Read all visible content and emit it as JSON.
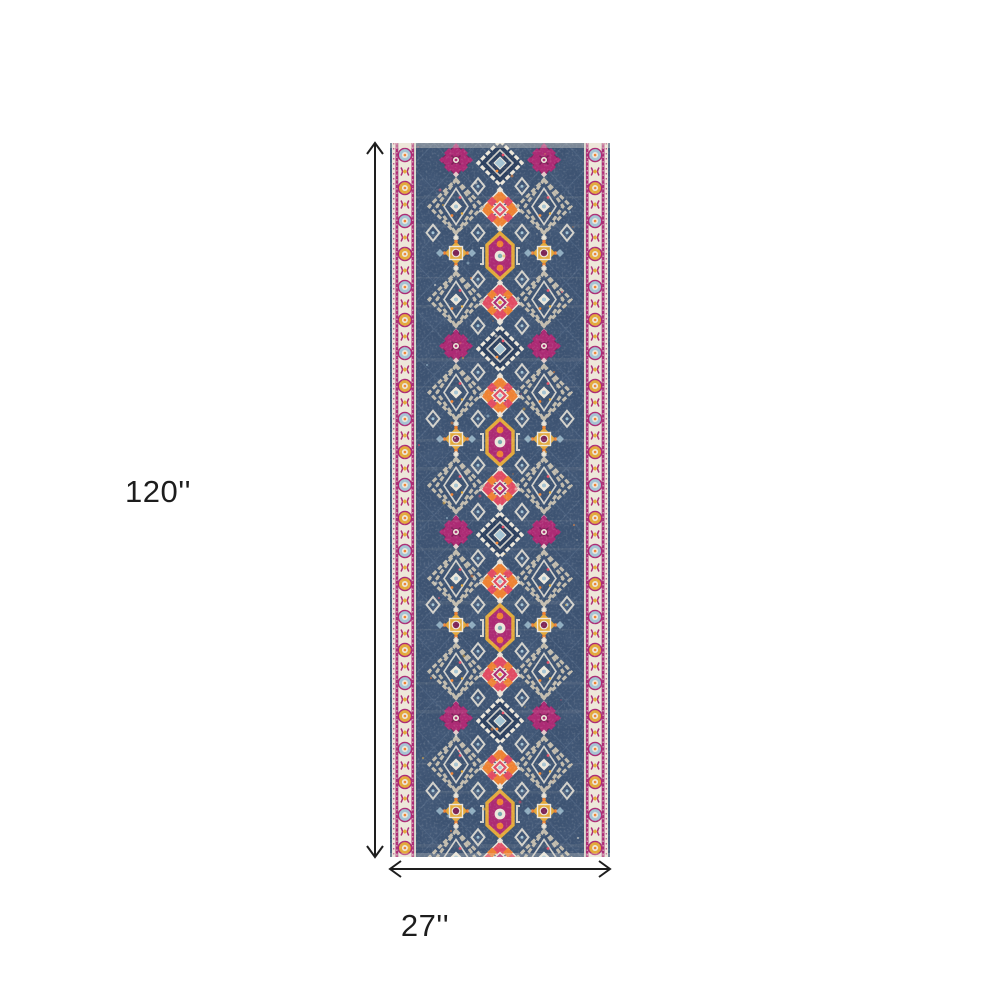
{
  "page": {
    "background": "#ffffff"
  },
  "diagram": {
    "type": "product-dimension-diagram",
    "length": {
      "label": "120''"
    },
    "width": {
      "label": "27''"
    },
    "arrow_color": "#1e1e1e",
    "text_color": "#1d1d1d"
  },
  "rug": {
    "description": "distressed bohemian medallion runner rug, navy field with ivory scroll side borders and magenta, orange, gold and light-blue medallions",
    "colors": {
      "field_navy": "#3d5372",
      "field_navy_dark": "#2c405f",
      "field_light": "#7b92ab",
      "cream": "#ede7da",
      "magenta": "#ac2a74",
      "magenta_dark": "#7d1d56",
      "pink_red": "#e14b63",
      "orange": "#ee8233",
      "gold": "#e3a93a",
      "light_blue": "#a4c3d3",
      "gray_tan": "#c2bcae",
      "teal": "#78aab2",
      "edge_blue": "#46607e"
    }
  }
}
